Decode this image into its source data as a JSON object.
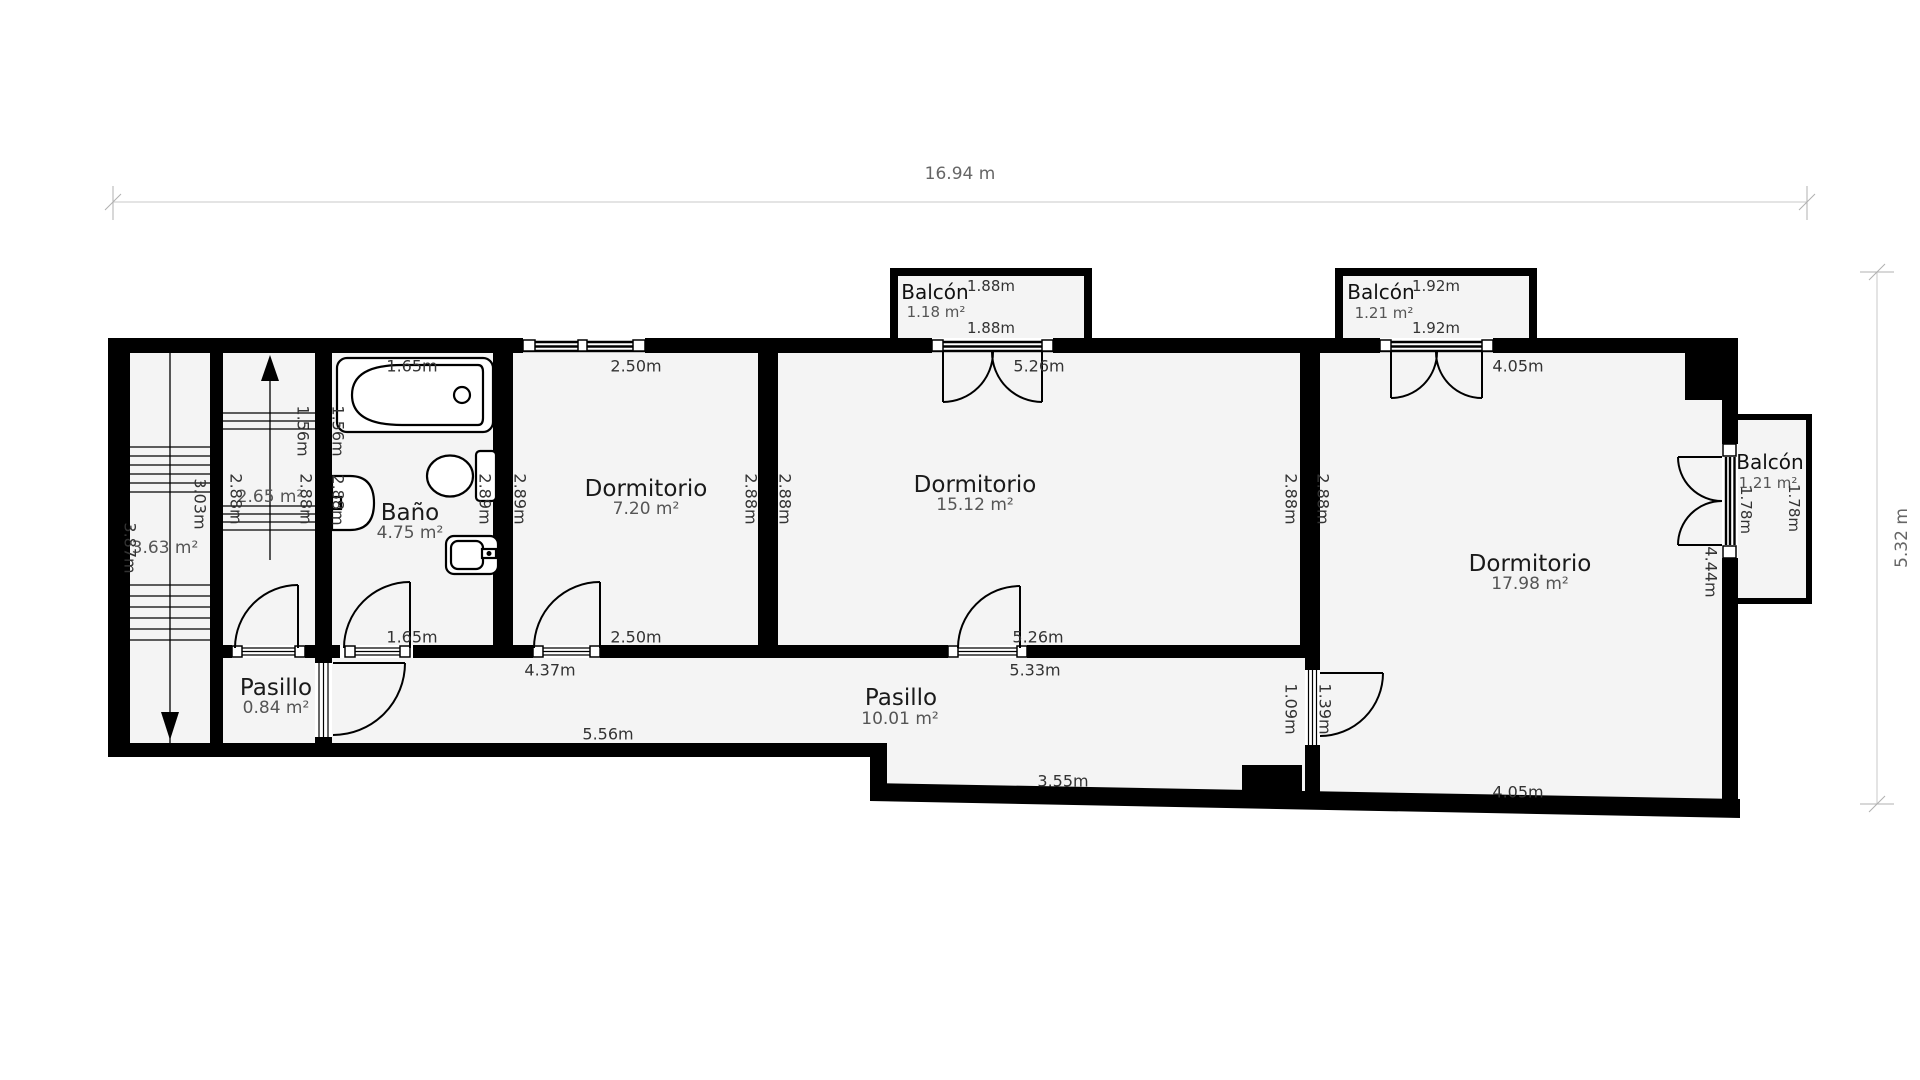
{
  "page": {
    "background": "#ffffff",
    "wall_color": "#000000",
    "room_fill": "#f4f4f4"
  },
  "outer_dimensions": {
    "width_label": "16.94 m",
    "height_label": "5.32 m"
  },
  "rooms": {
    "staircase_left": {
      "area": "3.63 m²",
      "dim_left": "3.87m",
      "dim_right": "3.03m"
    },
    "staircase_mid": {
      "area": "2.65 m²",
      "dim_left": "2.88m",
      "dim_right": "2.88m",
      "dim_top": "1.56m"
    },
    "bano": {
      "name": "Baño",
      "area": "4.75 m²",
      "dim_top": "1.65m",
      "dim_bottom": "1.65m",
      "dim_left_top": "1.56m",
      "dim_left": "2.88m",
      "dim_right": "2.89m"
    },
    "dormitorio_1": {
      "name": "Dormitorio",
      "area": "7.20 m²",
      "dim_top": "2.50m",
      "dim_bottom": "2.50m",
      "dim_left": "2.89m",
      "dim_right": "2.88m"
    },
    "dormitorio_2": {
      "name": "Dormitorio",
      "area": "15.12 m²",
      "dim_top": "5.26m",
      "dim_bottom": "5.26m",
      "dim_left": "2.88m",
      "dim_right": "2.88m"
    },
    "dormitorio_3": {
      "name": "Dormitorio",
      "area": "17.98 m²",
      "dim_top": "4.05m",
      "dim_bottom": "4.05m",
      "dim_left": "2.88m",
      "dim_right": "4.44m",
      "door_dim": "1.39m"
    },
    "pasillo_small": {
      "name": "Pasillo",
      "area": "0.84 m²"
    },
    "pasillo_main": {
      "name": "Pasillo",
      "area": "10.01 m²",
      "dim_1": "4.37m",
      "dim_2": "5.56m",
      "dim_3": "5.33m",
      "dim_4": "3.55m",
      "door_dim": "1.09m"
    },
    "balcon_top_left": {
      "name": "Balcón",
      "dim_sup": "1.88m",
      "area": "1.18 m²",
      "dim_bottom": "1.88m"
    },
    "balcon_top_right": {
      "name": "Balcón",
      "dim_sup": "1.92m",
      "area": "1.21 m²",
      "dim_bottom": "1.92m"
    },
    "balcon_right": {
      "name": "Balcón",
      "area": "1.21 m²",
      "dim_inner": "1.78m",
      "dim_outer": "1.78m"
    }
  }
}
